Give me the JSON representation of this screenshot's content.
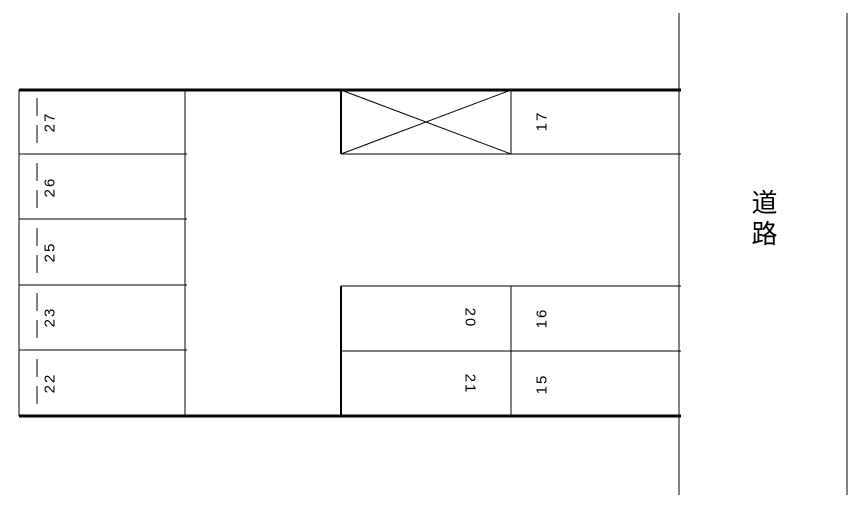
{
  "parking_lot": {
    "left_column_stalls": [
      "27",
      "26",
      "25",
      "23",
      "22"
    ],
    "top_right_block": {
      "crossed_out_stall_present": true,
      "stall": "17"
    },
    "bottom_right_block": {
      "inner_column_stalls": [
        "20",
        "21"
      ],
      "outer_column_stalls": [
        "16",
        "15"
      ]
    },
    "road_label": "道路"
  }
}
